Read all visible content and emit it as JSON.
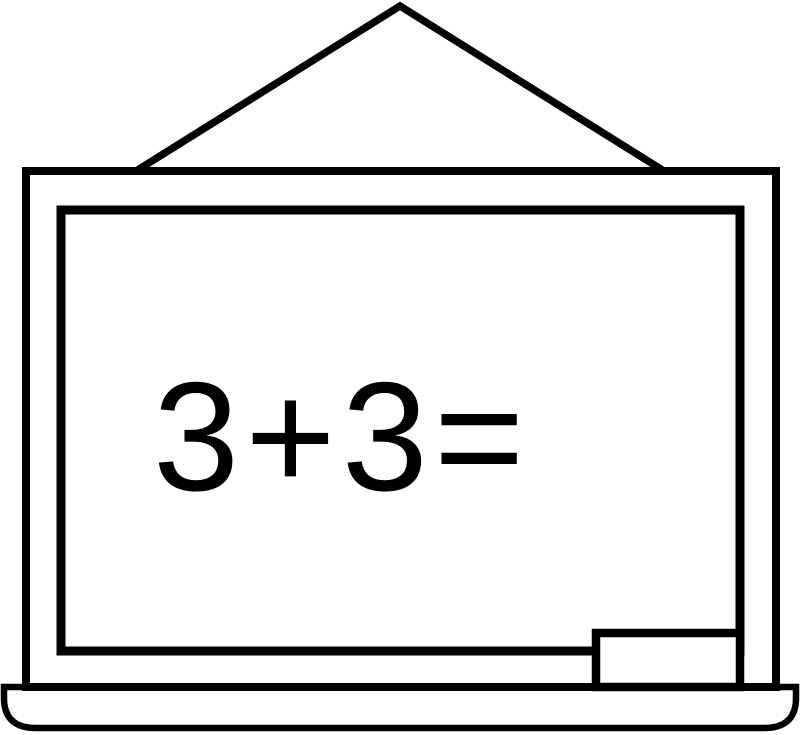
{
  "illustration": {
    "description": "black and white line-art drawing of a hanging classroom chalkboard",
    "equation": "3+3=",
    "colors": {
      "line": "#000000",
      "surface": "#ffffff"
    },
    "parts": {
      "hanger": "triangle hanger",
      "outer_frame": "board outer frame",
      "inner_frame": "board writing surface",
      "eraser": "eraser",
      "tray": "chalk tray"
    }
  }
}
